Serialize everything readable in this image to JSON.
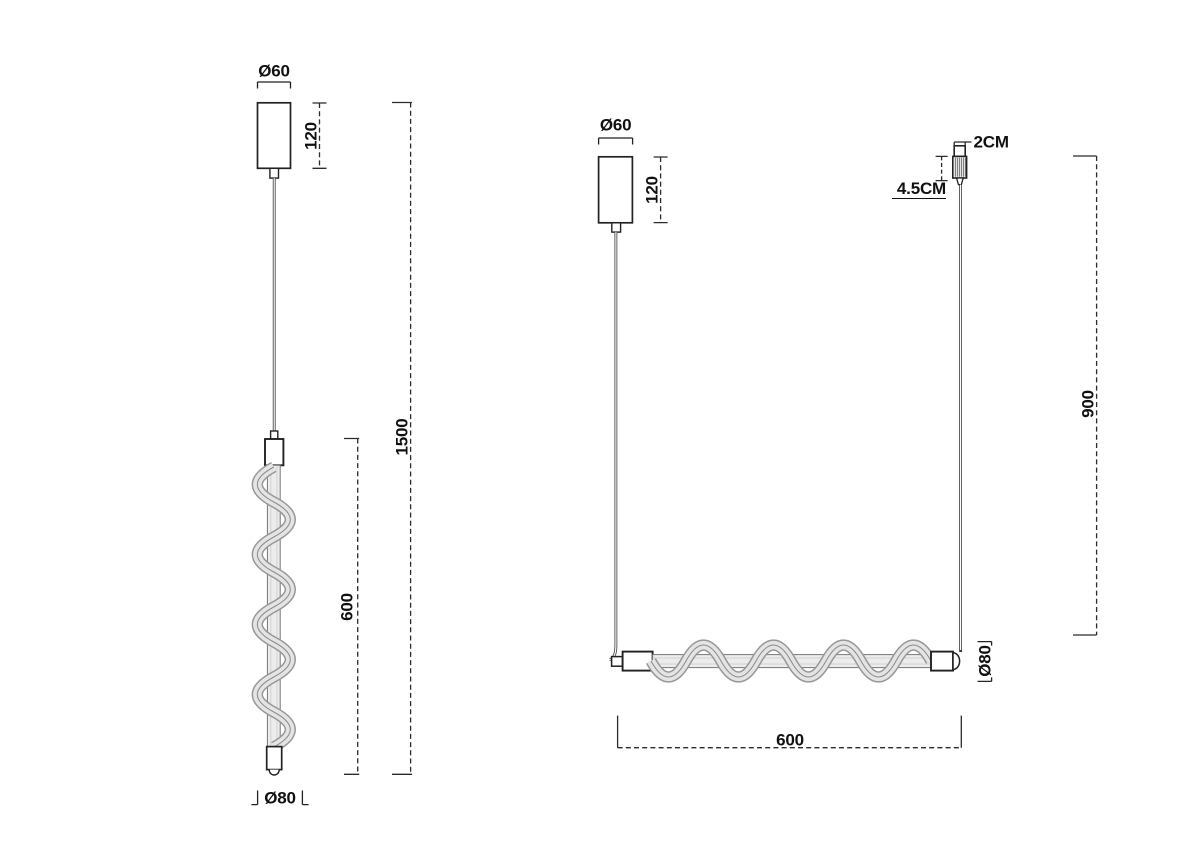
{
  "drawing": {
    "left_view": {
      "canopy_diameter": "Ø60",
      "canopy_height": "120",
      "fixture_length": "600",
      "overall_drop": "1500",
      "tube_diameter": "Ø80"
    },
    "right_view": {
      "canopy_diameter": "Ø60",
      "canopy_height": "120",
      "gripper_width": "2CM",
      "gripper_length": "4.5CM",
      "suspension_drop": "900",
      "tube_diameter": "Ø80",
      "tube_length": "600"
    },
    "colors": {
      "background": "#ffffff",
      "line": "#222222",
      "tube_fill": "#ececec",
      "spiral_fill": "#e4e4e4",
      "spiral_edge": "#979797"
    }
  }
}
